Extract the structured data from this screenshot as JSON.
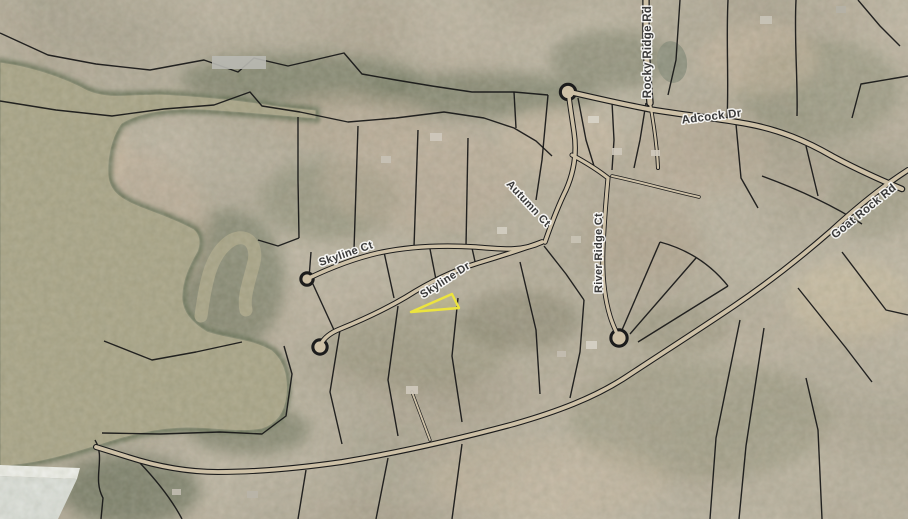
{
  "map": {
    "title": "Aerial parcel map with highlighted lot on Skyline Dr",
    "width": 908,
    "height": 519,
    "palette": {
      "land_base": "#a39884",
      "water": "#a7a284",
      "water_edge": "#667055",
      "parcel_line": "#161616",
      "road_fill": "#cdc0a6",
      "road_casing": "#1c1c1c",
      "highlight": "#ece43e",
      "label_text": "#3a3a3a",
      "label_halo": "#ffffff",
      "dam_face": "#f2f3ee",
      "dam_slope": "#dde1dc"
    },
    "labels": [
      {
        "id": "rocky-ridge-rd",
        "text": "Rocky Ridge Rd",
        "x": 651,
        "y": 52,
        "rot": -90,
        "size": 11.5
      },
      {
        "id": "adcock-dr",
        "text": "Adcock Dr",
        "x": 712,
        "y": 120,
        "rot": -7,
        "size": 11.5
      },
      {
        "id": "autumn-ct",
        "text": "Autumn Ct",
        "x": 526,
        "y": 206,
        "rot": 47,
        "size": 11
      },
      {
        "id": "skyline-ct",
        "text": "Skyline Ct",
        "x": 347,
        "y": 257,
        "rot": -19,
        "size": 11
      },
      {
        "id": "skyline-dr",
        "text": "Skyline Dr",
        "x": 447,
        "y": 283,
        "rot": -33,
        "size": 11
      },
      {
        "id": "river-ridge-ct",
        "text": "River Ridge Ct",
        "x": 602,
        "y": 253,
        "rot": -90,
        "size": 11
      },
      {
        "id": "goat-rock-rd",
        "text": "Goat Rock Rd",
        "x": 866,
        "y": 214,
        "rot": -39,
        "size": 11.5
      }
    ],
    "water": {
      "lake_path": "M 0 62 C 30 66 62 76 88 90 C 100 95 112 96 128 95 L 160 94 C 200 96 240 100 278 106 L 316 110 L 316 119 C 280 116 240 112 200 110 C 168 109 140 113 122 124 C 112 138 108 158 109 175 C 110 190 120 198 140 206 C 158 213 178 220 194 229 C 200 234 202 242 198 252 C 190 266 182 282 183 300 C 184 312 192 322 207 331 C 226 338 252 338 272 350 C 284 360 289 376 287 396 C 285 412 278 424 262 429 C 240 433 214 428 188 428 C 158 428 128 436 103 444 C 80 451 52 460 24 464 L 0 467 Z",
      "hook_cove_path": "M 201 316 C 206 278 212 252 232 240 C 249 232 259 247 253 266 C 249 282 243 298 246 310",
      "pond": {
        "cx": 672,
        "cy": 62,
        "rx": 15,
        "ry": 21,
        "rot": -8,
        "fill": "#8b8e7c"
      },
      "dam_face_path": "M 0 465 L 80 468 L 77 479 L 0 476 Z",
      "dam_slope_path": "M 0 476 L 77 479 L 58 519 L 0 519 Z"
    },
    "roads": [
      {
        "name": "rocky-ridge-rd",
        "path": "M 646 0 L 646 30 C 646 55 648 80 650 103",
        "casing": 7.5,
        "width": 5
      },
      {
        "name": "rocky-ridge-driveway",
        "path": "M 650 103 C 654 125 657 145 658 168",
        "casing": 4,
        "width": 2.2
      },
      {
        "name": "adcock-dr",
        "path": "M 574 93 C 600 99 622 104 648 109 C 690 116 716 118 748 124 C 780 130 806 141 832 156 C 856 169 876 178 902 189",
        "casing": 6.5,
        "width": 4.2
      },
      {
        "name": "goat-rock-rd",
        "path": "M 908 170 C 880 188 856 208 832 230 C 800 258 768 283 734 306 C 700 329 664 352 626 377 C 594 398 556 412 514 424 C 462 438 402 452 342 462 C 300 468 258 472 218 472 C 186 472 156 466 128 457 L 96 447",
        "casing": 6,
        "width": 3.8
      },
      {
        "name": "autumn-ct",
        "path": "M 545 242 C 552 222 558 206 566 190 C 574 172 577 152 574 132 C 572 118 570 106 569 97",
        "casing": 5.5,
        "width": 3.5
      },
      {
        "name": "skyline-ct",
        "path": "M 309 278 C 330 268 352 259 378 253 C 410 246 444 245 476 247 C 500 249 522 252 542 242",
        "casing": 5.5,
        "width": 3.5
      },
      {
        "name": "skyline-dr",
        "path": "M 542 242 C 520 250 498 257 478 263 C 452 271 428 283 406 297 C 384 310 362 320 340 329 C 330 333 324 338 321 344",
        "casing": 5.5,
        "width": 3.5
      },
      {
        "name": "river-ridge-ct",
        "path": "M 572 155 C 585 162 598 170 608 178 C 606 200 604 224 603 248 C 602 272 604 296 610 316 C 613 326 616 331 618 336",
        "casing": 5,
        "width": 3.2
      },
      {
        "name": "river-ridge-driveway",
        "path": "M 612 176 C 640 182 668 190 699 197",
        "casing": 3.5,
        "width": 2
      },
      {
        "name": "goat-rock-driveway",
        "path": "M 430 440 L 412 392",
        "casing": 3.2,
        "width": 1.8
      }
    ],
    "culdesacs": [
      {
        "name": "adcock-bulb",
        "x": 568,
        "y": 92,
        "r": 7.5
      },
      {
        "name": "skyline-ct-bulb",
        "x": 307,
        "y": 279,
        "r": 6
      },
      {
        "name": "skyline-dr-bulb",
        "x": 320,
        "y": 347,
        "r": 7
      },
      {
        "name": "river-ridge-bulb",
        "x": 619,
        "y": 338,
        "r": 8
      }
    ],
    "parcel_lines": [
      "M0 33 L48 55 L96 64 L150 70 L204 60 L238 72 L254 58 L288 66 L314 60 L344 53 L362 74 L396 80 L432 86 L472 92 L514 92 L548 95",
      "M0 101 L56 110 L112 116 L164 109 L214 105 L250 92 L262 106 L300 112 L348 122 L396 118 L444 112 L484 118 L514 128 L536 141 L552 156",
      "M298 117 L298 180 L299 238",
      "M358 126 L354 250",
      "M418 130 L414 247",
      "M468 138 L466 246",
      "M514 92 L516 128",
      "M548 95 L542 160 L536 200",
      "M578 98 L586 140 L594 166",
      "M612 102 L614 140 L612 170",
      "M646 103 L640 140 L634 168",
      "M680 0 L676 60 L668 95",
      "M728 0 C726 40 729 80 727 120",
      "M796 0 C794 40 798 80 797 116",
      "M858 0 L880 26 L900 46",
      "M852 118 L861 84 L908 76",
      "M736 124 L741 178 L758 208",
      "M762 176 C800 190 834 206 862 224",
      "M806 146 L818 196",
      "M842 252 L886 310 L908 315",
      "M798 288 L846 348 L872 382",
      "M740 320 L716 438 L710 519",
      "M764 328 L746 446 L739 519",
      "M822 519 L818 430 L806 378",
      "M622 330 L660 242",
      "M630 334 L696 258",
      "M638 342 L728 286",
      "M660 242 C690 250 712 266 728 286",
      "M544 246 L566 274 L584 300",
      "M584 300 L580 352 L570 398",
      "M340 330 L330 392 L342 444",
      "M398 306 L388 380 L398 436",
      "M458 298 L452 356 L462 422",
      "M520 262 L536 330 L540 394",
      "M384 252 L394 298",
      "M430 249 L438 290",
      "M472 248 L476 266",
      "M309 278 L311 252",
      "M312 282 L334 330",
      "M299 238 L278 246 L258 240",
      "M104 341 L152 360 L196 352 L242 342",
      "M102 433 L160 434 L220 432 L262 434 L286 416 L292 374 L284 346",
      "M95 440 C106 458 92 478 103 498 L101 519",
      "M140 463 C158 482 172 500 182 519",
      "M306 470 L298 519",
      "M388 458 L376 519",
      "M462 444 L452 519"
    ],
    "highlight_parcel": {
      "points": "452,294 411,312 459,308",
      "stroke": "#ece43e",
      "stroke_width": 2.4,
      "fill": "rgba(250,245,60,0.10)"
    },
    "blobs": [
      {
        "cx": 300,
        "cy": 80,
        "rx": 120,
        "ry": 26,
        "fill": "#646d55",
        "op": 0.55
      },
      {
        "cx": 480,
        "cy": 95,
        "rx": 120,
        "ry": 22,
        "fill": "#5d6750",
        "op": 0.5
      },
      {
        "cx": 610,
        "cy": 60,
        "rx": 60,
        "ry": 30,
        "fill": "#6a715a",
        "op": 0.5
      },
      {
        "cx": 230,
        "cy": 280,
        "rx": 55,
        "ry": 70,
        "fill": "#5d6750",
        "op": 0.5
      },
      {
        "cx": 160,
        "cy": 380,
        "rx": 90,
        "ry": 50,
        "fill": "#646d55",
        "op": 0.55
      },
      {
        "cx": 130,
        "cy": 490,
        "rx": 70,
        "ry": 35,
        "fill": "#59624c",
        "op": 0.6
      },
      {
        "cx": 330,
        "cy": 200,
        "rx": 70,
        "ry": 40,
        "fill": "#7c8168",
        "op": 0.45
      },
      {
        "cx": 700,
        "cy": 420,
        "rx": 130,
        "ry": 60,
        "fill": "#8a8a70",
        "op": 0.4
      },
      {
        "cx": 820,
        "cy": 90,
        "rx": 80,
        "ry": 50,
        "fill": "#7e8268",
        "op": 0.4
      },
      {
        "cx": 420,
        "cy": 350,
        "rx": 90,
        "ry": 40,
        "fill": "#8f8c72",
        "op": 0.4
      },
      {
        "cx": 120,
        "cy": 230,
        "rx": 90,
        "ry": 80,
        "fill": "#c0ad98",
        "op": 0.5
      },
      {
        "cx": 60,
        "cy": 150,
        "rx": 70,
        "ry": 60,
        "fill": "#cdbaa2",
        "op": 0.5
      },
      {
        "cx": 420,
        "cy": 180,
        "rx": 100,
        "ry": 50,
        "fill": "#c0ad98",
        "op": 0.45
      },
      {
        "cx": 560,
        "cy": 140,
        "rx": 60,
        "ry": 35,
        "fill": "#cdbaa2",
        "op": 0.45
      },
      {
        "cx": 700,
        "cy": 150,
        "rx": 70,
        "ry": 45,
        "fill": "#c0ad98",
        "op": 0.4
      },
      {
        "cx": 760,
        "cy": 60,
        "rx": 60,
        "ry": 35,
        "fill": "#cdbaa2",
        "op": 0.45
      },
      {
        "cx": 550,
        "cy": 480,
        "rx": 120,
        "ry": 40,
        "fill": "#c3b29a",
        "op": 0.4
      },
      {
        "cx": 850,
        "cy": 300,
        "rx": 60,
        "ry": 40,
        "fill": "#cfc0a0",
        "op": 0.5
      },
      {
        "cx": 350,
        "cy": 120,
        "rx": 80,
        "ry": 30,
        "fill": "#b7a690",
        "op": 0.45
      },
      {
        "cx": 640,
        "cy": 240,
        "rx": 60,
        "ry": 40,
        "fill": "#b3a28c",
        "op": 0.4
      },
      {
        "cx": 90,
        "cy": 300,
        "rx": 40,
        "ry": 50,
        "fill": "#6d7459",
        "op": 0.5
      },
      {
        "cx": 520,
        "cy": 320,
        "rx": 60,
        "ry": 30,
        "fill": "#79765f",
        "op": 0.45
      },
      {
        "cx": 250,
        "cy": 430,
        "rx": 60,
        "ry": 25,
        "fill": "#5f684f",
        "op": 0.55
      },
      {
        "cx": 680,
        "cy": 330,
        "rx": 50,
        "ry": 25,
        "fill": "#8b8870",
        "op": 0.4
      },
      {
        "cx": 870,
        "cy": 200,
        "rx": 40,
        "ry": 40,
        "fill": "#8f8e76",
        "op": 0.4
      }
    ],
    "structures": [
      {
        "x": 212,
        "y": 56,
        "w": 54,
        "h": 13,
        "fill": "#b9b9b3"
      },
      {
        "x": 430,
        "y": 133,
        "w": 12,
        "h": 8,
        "fill": "#cfc9bd"
      },
      {
        "x": 381,
        "y": 156,
        "w": 10,
        "h": 7,
        "fill": "#c8c2b6"
      },
      {
        "x": 588,
        "y": 116,
        "w": 11,
        "h": 7,
        "fill": "#d8d4c8"
      },
      {
        "x": 612,
        "y": 148,
        "w": 10,
        "h": 7,
        "fill": "#cfc9bb"
      },
      {
        "x": 651,
        "y": 150,
        "w": 9,
        "h": 6,
        "fill": "#d0cabe"
      },
      {
        "x": 760,
        "y": 16,
        "w": 12,
        "h": 8,
        "fill": "#c9c4b8"
      },
      {
        "x": 836,
        "y": 6,
        "w": 10,
        "h": 7,
        "fill": "#b5b1a6"
      },
      {
        "x": 497,
        "y": 227,
        "w": 10,
        "h": 7,
        "fill": "#d3cec2"
      },
      {
        "x": 571,
        "y": 236,
        "w": 10,
        "h": 7,
        "fill": "#c9c3b5"
      },
      {
        "x": 586,
        "y": 341,
        "w": 11,
        "h": 8,
        "fill": "#d6d2c6"
      },
      {
        "x": 557,
        "y": 351,
        "w": 9,
        "h": 6,
        "fill": "#c3bdb0"
      },
      {
        "x": 406,
        "y": 386,
        "w": 12,
        "h": 8,
        "fill": "#cfc9bc"
      },
      {
        "x": 247,
        "y": 491,
        "w": 11,
        "h": 7,
        "fill": "#b9b5a9"
      },
      {
        "x": 172,
        "y": 489,
        "w": 9,
        "h": 6,
        "fill": "#c2bdb1"
      }
    ]
  }
}
